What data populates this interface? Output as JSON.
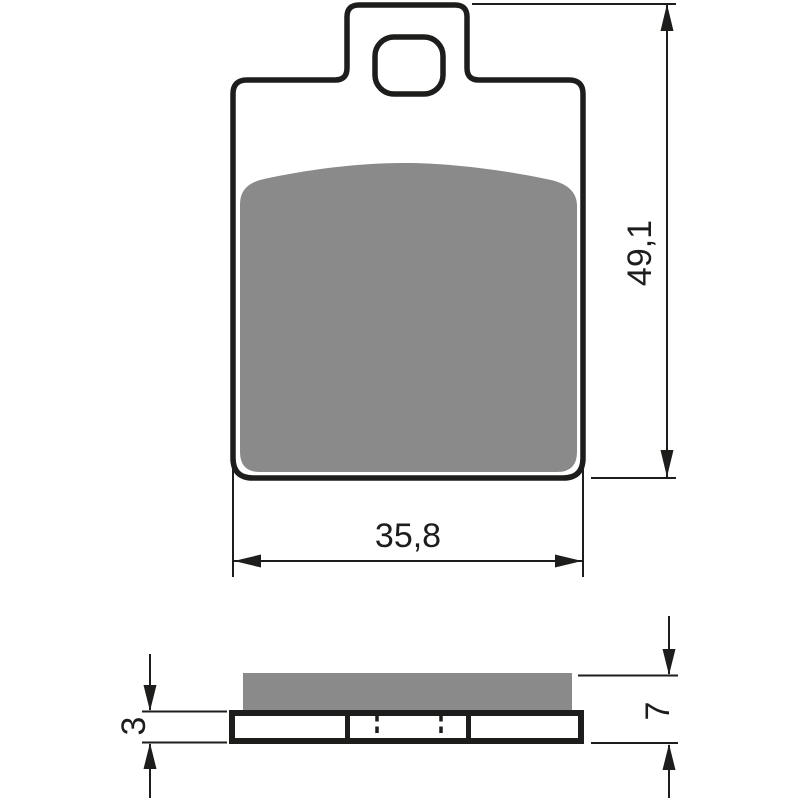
{
  "drawing": {
    "dimensions": {
      "height": "49,1",
      "width": "35,8",
      "backing_plate_thickness": "3",
      "total_thickness": "7"
    },
    "colors": {
      "line": "#1d1d1b",
      "friction_material": "#8a8a8a",
      "background": "#ffffff"
    }
  }
}
